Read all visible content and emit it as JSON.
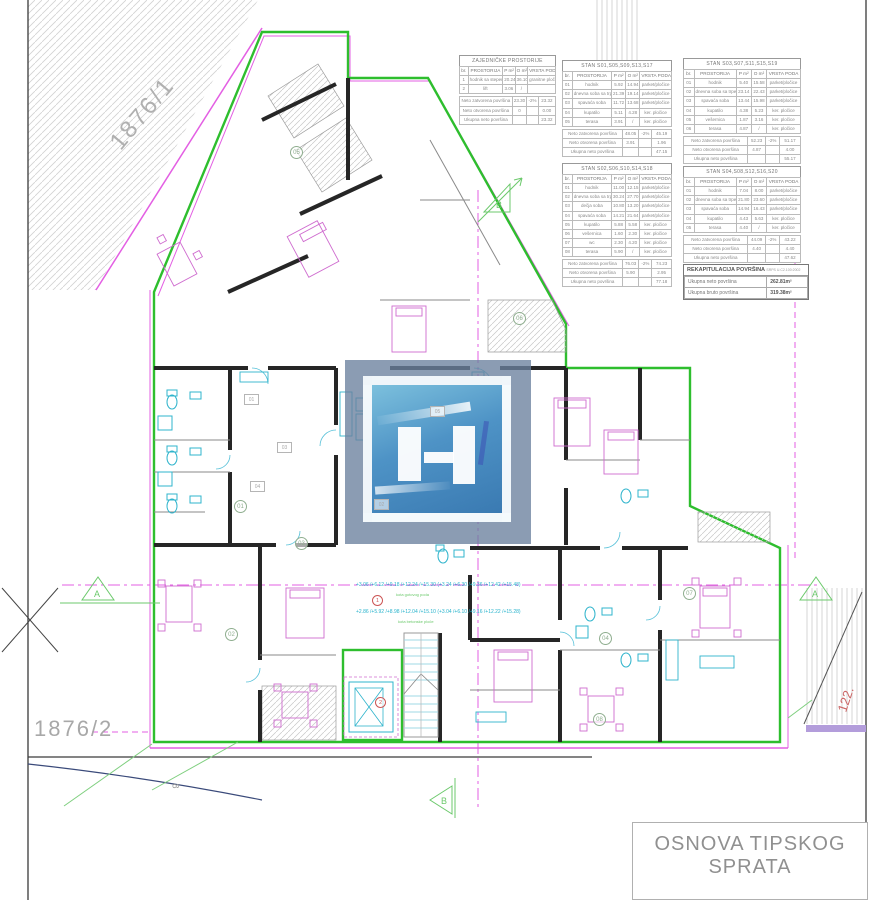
{
  "title_block": {
    "title": "OSNOVA TIPSKOG SPRATA"
  },
  "parcels": {
    "upper": "1876/1",
    "lower": "1876/2",
    "right": "122.",
    "north": "8"
  },
  "section_markers": {
    "a": "A",
    "b": "B"
  },
  "levels": {
    "line1": "+3.06 /+6.12 /+9.18 /+12.24 /+15.30  (+3.24 /+6.30 /+9.36 /+12.42 /+15.48)",
    "label1": "kota gotovog poda",
    "line2": "+2.86 /+5.92 /+8.98 /+12.04 /+15.10  (+3.04 /+6.10 /+9.16 /+12.22 /+15.28)",
    "label2": "kota betonske ploče"
  },
  "tables": [
    {
      "title": "ZAJEDNIČKE PROSTORIJE",
      "cols": [
        "br.",
        "PROSTORIJA",
        "P m²",
        "O m²",
        "VRSTA PODA"
      ],
      "rows": [
        [
          "1",
          "hodnik sa stepeništem",
          "20.24",
          "36.10",
          "granitne ploče"
        ],
        [
          "2",
          "lift",
          "3.06",
          "/",
          ""
        ]
      ],
      "footer": [
        [
          "Neto zatvorena površina",
          "23.30",
          "-2%",
          "23.32"
        ],
        [
          "Neto otvorena površina",
          "0",
          "",
          "0.00"
        ],
        [
          "Ukupna neto površina",
          "",
          "",
          "23.32"
        ]
      ]
    },
    {
      "title": "STAN S01,S05,S09,S13,S17",
      "cols": [
        "br.",
        "PROSTORIJA",
        "P m²",
        "O m²",
        "VRSTA PODA"
      ],
      "rows": [
        [
          "01",
          "hodnik",
          "5.92",
          "14.94",
          "parket/pločice"
        ],
        [
          "02",
          "dnevna soba sa trpezarijom",
          "21.39",
          "19.14",
          "parket/pločice"
        ],
        [
          "03",
          "spavaća soba",
          "11.72",
          "13.68",
          "parket/pločice"
        ],
        [
          "04",
          "kupatilo",
          "5.11",
          "4.28",
          "ker. pločice"
        ],
        [
          "05",
          "terasa",
          "3.91",
          "/",
          "ker. pločice"
        ]
      ],
      "footer": [
        [
          "Neto zatvorena površina",
          "48.05",
          "-2%",
          "45.19"
        ],
        [
          "Neto otvorena površina",
          "3.91",
          "",
          "1.96"
        ],
        [
          "Ukupna neto površina",
          "",
          "",
          "47.15"
        ]
      ]
    },
    {
      "title": "STAN S03,S07,S11,S15,S19",
      "cols": [
        "br.",
        "PROSTORIJA",
        "P m²",
        "O m²",
        "VRSTA PODA"
      ],
      "rows": [
        [
          "01",
          "hodnik",
          "5.40",
          "15.58",
          "parket/pločice"
        ],
        [
          "02",
          "dnevna soba sa trpezarijom",
          "23.14",
          "22.43",
          "parket/pločice"
        ],
        [
          "03",
          "spavaća soba",
          "13.44",
          "15.98",
          "parket/pločice"
        ],
        [
          "04",
          "kupatilo",
          "4.38",
          "5.23",
          "ker. pločice"
        ],
        [
          "05",
          "vešernica",
          "1.87",
          "3.16",
          "ker. pločice"
        ],
        [
          "06",
          "terasa",
          "4.87",
          "/",
          "ker. pločice"
        ]
      ],
      "footer": [
        [
          "Neto zatvorena površina",
          "52.23",
          "-2%",
          "51.17"
        ],
        [
          "Neto otvorena površina",
          "4.87",
          "",
          "4.00"
        ],
        [
          "Ukupna neto površina",
          "",
          "",
          "55.17"
        ]
      ]
    },
    {
      "title": "STAN S02,S06,S10,S14,S18",
      "cols": [
        "br.",
        "PROSTORIJA",
        "P m²",
        "O m²",
        "VRSTA PODA"
      ],
      "rows": [
        [
          "01",
          "hodnik",
          "11.00",
          "12.15",
          "parket/pločice"
        ],
        [
          "02",
          "dnevna soba sa trpezarijom",
          "30.24",
          "27.70",
          "parket/pločice"
        ],
        [
          "03",
          "dečja soba",
          "10.80",
          "13.20",
          "parket/pločice"
        ],
        [
          "04",
          "spavaća soba",
          "14.21",
          "21.64",
          "parket/pločice"
        ],
        [
          "05",
          "kupatilo",
          "5.88",
          "5.58",
          "ker. pločice"
        ],
        [
          "06",
          "vešernica",
          "1.60",
          "2.30",
          "ker. pločice"
        ],
        [
          "07",
          "wc",
          "2.30",
          "4.20",
          "ker. pločice"
        ],
        [
          "08",
          "terasa",
          "5.90",
          "/",
          "ker. pločice"
        ]
      ],
      "footer": [
        [
          "Neto zatvorena površina",
          "76.03",
          "-2%",
          "74.23"
        ],
        [
          "Neto otvorena površina",
          "5.90",
          "",
          "2.95"
        ],
        [
          "Ukupna neto površina",
          "",
          "",
          "77.18"
        ]
      ]
    },
    {
      "title": "STAN S04,S08,S12,S16,S20",
      "cols": [
        "br.",
        "PROSTORIJA",
        "P m²",
        "O m²",
        "VRSTA PODA"
      ],
      "rows": [
        [
          "01",
          "hodnik",
          "7.04",
          "8.00",
          "parket/pločice"
        ],
        [
          "02",
          "dnevna soba sa trpezarijom",
          "21.80",
          "23.60",
          "parket/pločice"
        ],
        [
          "03",
          "spavaća soba",
          "14.94",
          "16.43",
          "parket/pločice"
        ],
        [
          "04",
          "kupatilo",
          "4.43",
          "5.63",
          "ker. pločice"
        ],
        [
          "05",
          "terasa",
          "4.40",
          "/",
          "ker. pločice"
        ]
      ],
      "footer": [
        [
          "Neto zatvorena površina",
          "44.09",
          "-2%",
          "43.22"
        ],
        [
          "Neto otvorena površina",
          "4.40",
          "",
          "4.40"
        ],
        [
          "Ukupna neto površina",
          "",
          "",
          "47.62"
        ]
      ]
    }
  ],
  "recap": {
    "title": "REKAPITULACIJA POVRŠINA",
    "standard": "SRPS U.C2.100:2002",
    "rows": [
      [
        "Ukupna neto površina",
        "262.81m²"
      ],
      [
        "Ukupna bruto površina",
        "319.38m²"
      ]
    ]
  },
  "plan": {
    "circle_tags": [
      {
        "n": "05",
        "x": 290,
        "y": 146
      },
      {
        "n": "06",
        "x": 513,
        "y": 312
      },
      {
        "n": "01",
        "x": 234,
        "y": 500
      },
      {
        "n": "03",
        "x": 295,
        "y": 537
      },
      {
        "n": "02",
        "x": 225,
        "y": 628
      },
      {
        "n": "04",
        "x": 599,
        "y": 632
      },
      {
        "n": "07",
        "x": 683,
        "y": 587
      },
      {
        "n": "08",
        "x": 593,
        "y": 713
      }
    ],
    "pent_tags": [
      {
        "n": "01",
        "x": 244,
        "y": 394
      },
      {
        "n": "02",
        "x": 374,
        "y": 499
      },
      {
        "n": "03",
        "x": 277,
        "y": 442
      },
      {
        "n": "04",
        "x": 250,
        "y": 481
      },
      {
        "n": "05",
        "x": 430,
        "y": 406
      }
    ],
    "red_tags": [
      {
        "n": "1",
        "x": 372,
        "y": 595
      },
      {
        "n": "2",
        "x": 375,
        "y": 697
      }
    ]
  }
}
